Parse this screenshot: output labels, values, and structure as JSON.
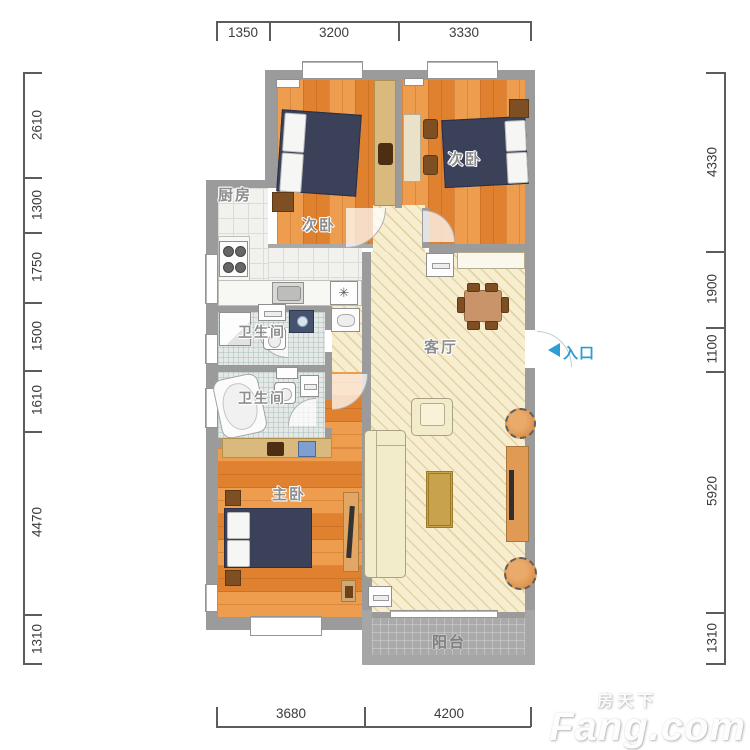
{
  "plan": {
    "rooms": {
      "kitchen": "厨房",
      "bedroom_top_left": "次卧",
      "bedroom_top_right": "次卧",
      "bath_upper": "卫生间",
      "bath_lower": "卫生间",
      "living": "客厅",
      "master": "主卧",
      "balcony": "阳台"
    },
    "entrance": {
      "label": "入口"
    },
    "kitchen_gas_symbol": "✳"
  },
  "dimensions": {
    "top": [
      "1350",
      "3200",
      "3330"
    ],
    "bottom": [
      "3680",
      "4200"
    ],
    "left": [
      "2610",
      "1300",
      "1750",
      "1500",
      "1610",
      "4470",
      "1310"
    ],
    "right": [
      "4330",
      "1900",
      "1100",
      "5920",
      "1310"
    ]
  },
  "watermark": {
    "site_cn": "房天下",
    "site_en": "Fang.com"
  },
  "colors": {
    "wall": "#9b9b9b",
    "wood_floor": "#e5893a",
    "living_floor": "#f7eecf",
    "entrance_blue": "#2d9ed2"
  }
}
